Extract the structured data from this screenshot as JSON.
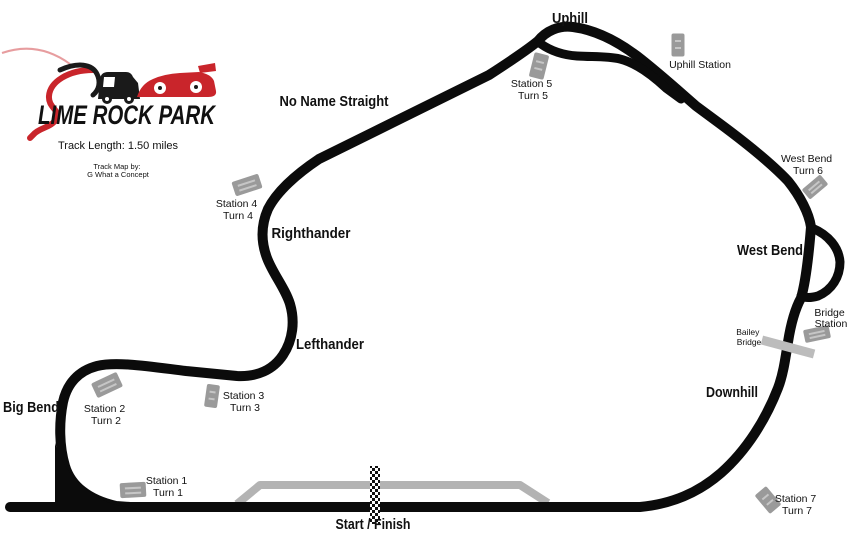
{
  "logo": {
    "title": "LIME ROCK PARK",
    "track_length": "Track Length: 1.50 miles",
    "credit_line1": "Track Map by:",
    "credit_line2": "G What a Concept"
  },
  "track_labels": {
    "uphill": "Uphill",
    "no_name_straight": "No Name Straight",
    "righthander": "Righthander",
    "lefthander": "Lefthander",
    "big_bend": "Big Bend",
    "west_bend": "West Bend",
    "downhill": "Downhill",
    "start_finish": "Start / Finish"
  },
  "stations": [
    {
      "id": "station-1",
      "line1": "Station 1",
      "line2": "Turn 1"
    },
    {
      "id": "station-2",
      "line1": "Station 2",
      "line2": "Turn 2"
    },
    {
      "id": "station-3",
      "line1": "Station 3",
      "line2": "Turn 3"
    },
    {
      "id": "station-4",
      "line1": "Station 4",
      "line2": "Turn 4"
    },
    {
      "id": "station-5",
      "line1": "Station 5",
      "line2": "Turn 5"
    },
    {
      "id": "uphill-station",
      "line1": "Uphill Station",
      "line2": ""
    },
    {
      "id": "west-bend-turn-6",
      "line1": "West Bend",
      "line2": "Turn 6"
    },
    {
      "id": "bridge-station",
      "line1": "Bridge",
      "line2": "Station"
    },
    {
      "id": "bailey-bridge",
      "line1": "Bailey",
      "line2": "Bridge"
    },
    {
      "id": "station-7",
      "line1": "Station 7",
      "line2": "Turn 7"
    }
  ],
  "colors": {
    "track": "#0b0b0b",
    "pit_lane": "#b3b3b3",
    "marker": "#9a9a9a",
    "marker_stripe": "#c6c6c6",
    "bridge_bar": "#bcbcbc",
    "logo_red": "#c9252b",
    "text": "#111111"
  }
}
